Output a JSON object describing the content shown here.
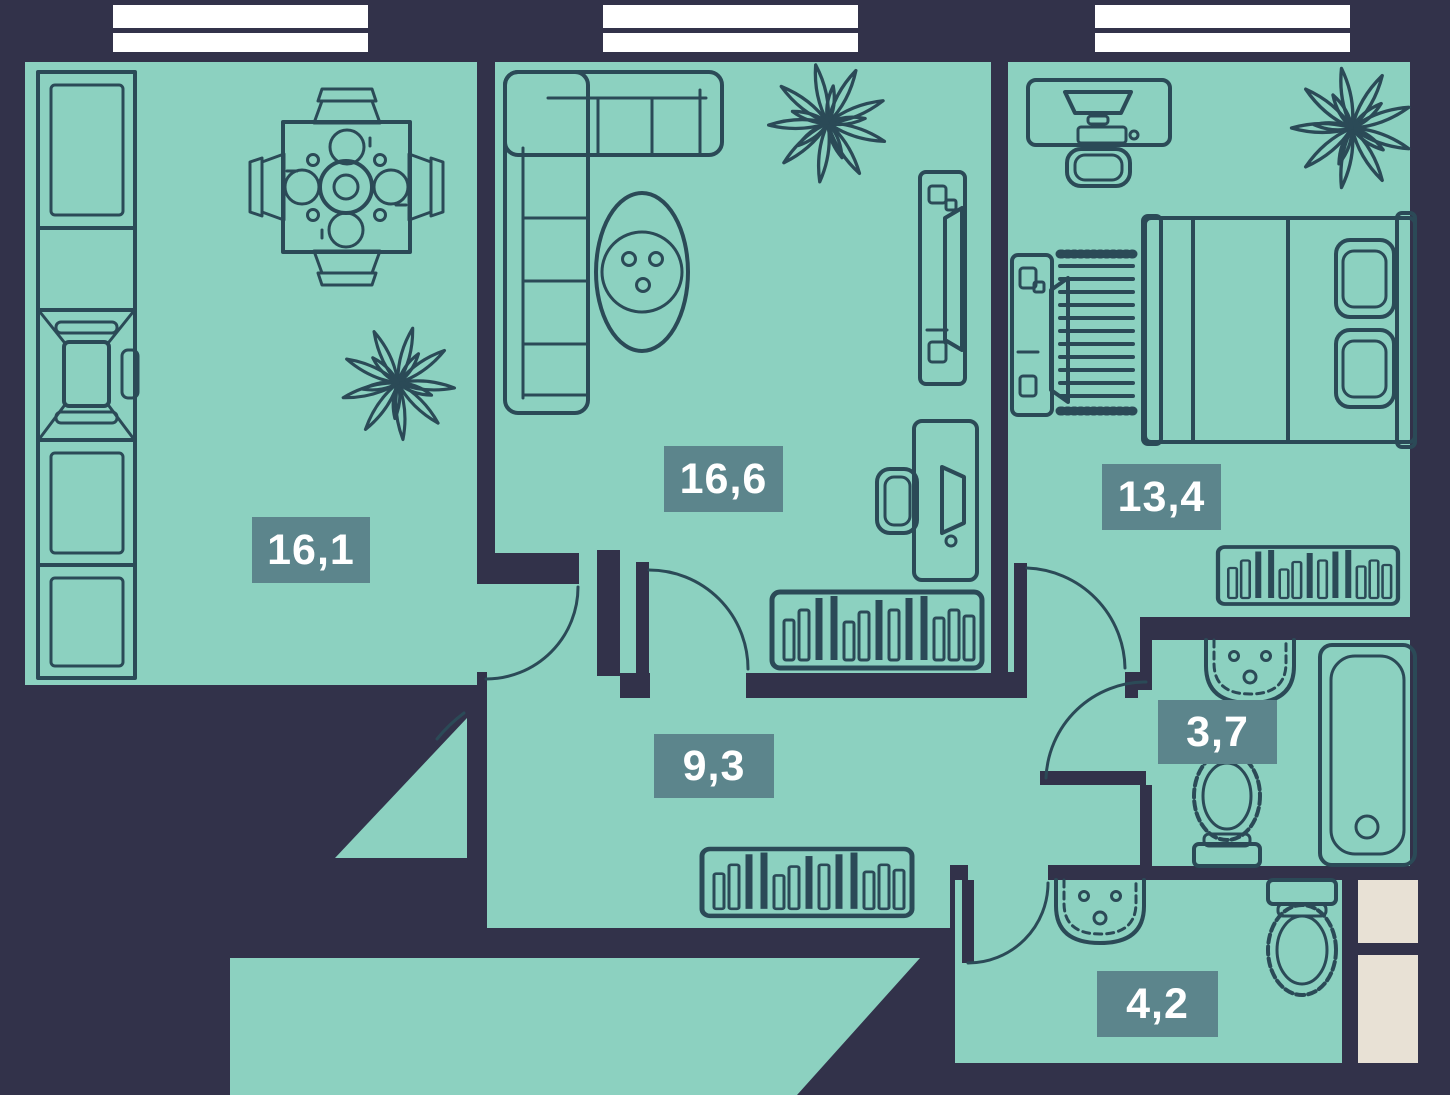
{
  "plan": {
    "type": "apartment-floor-plan",
    "rooms": [
      {
        "name": "kitchen-dining-room",
        "area_label": "16,1",
        "furniture": [
          "kitchen-counter",
          "stove",
          "dining-table",
          "dining-chairs",
          "plant"
        ]
      },
      {
        "name": "living-room",
        "area_label": "16,6",
        "furniture": [
          "corner-sofa",
          "coffee-table",
          "plant",
          "tv-unit",
          "desk",
          "desk-chair",
          "monitor",
          "shelf"
        ]
      },
      {
        "name": "bedroom",
        "area_label": "13,4",
        "furniture": [
          "desk",
          "monitor",
          "desk-chair",
          "plant",
          "double-bed",
          "pillows",
          "tv-unit",
          "rug",
          "shelf"
        ]
      },
      {
        "name": "hallway",
        "area_label": "9,3",
        "furniture": [
          "shelf",
          "entrance-door"
        ]
      },
      {
        "name": "bathroom",
        "area_label": "3,7",
        "furniture": [
          "sink",
          "toilet",
          "bathtub"
        ]
      },
      {
        "name": "toilet-room",
        "area_label": "4,2",
        "furniture": [
          "sink",
          "toilet"
        ]
      }
    ],
    "windows": 3,
    "doors": 6,
    "colors": {
      "floor": "#8CD1C0",
      "walls": "#32324A",
      "furniture_line": "#2B4A57",
      "label_bg": "#5C858C",
      "label_text": "#FFFFFF",
      "window": "#FFFFFF",
      "shaft": "#E8E1D5"
    }
  }
}
